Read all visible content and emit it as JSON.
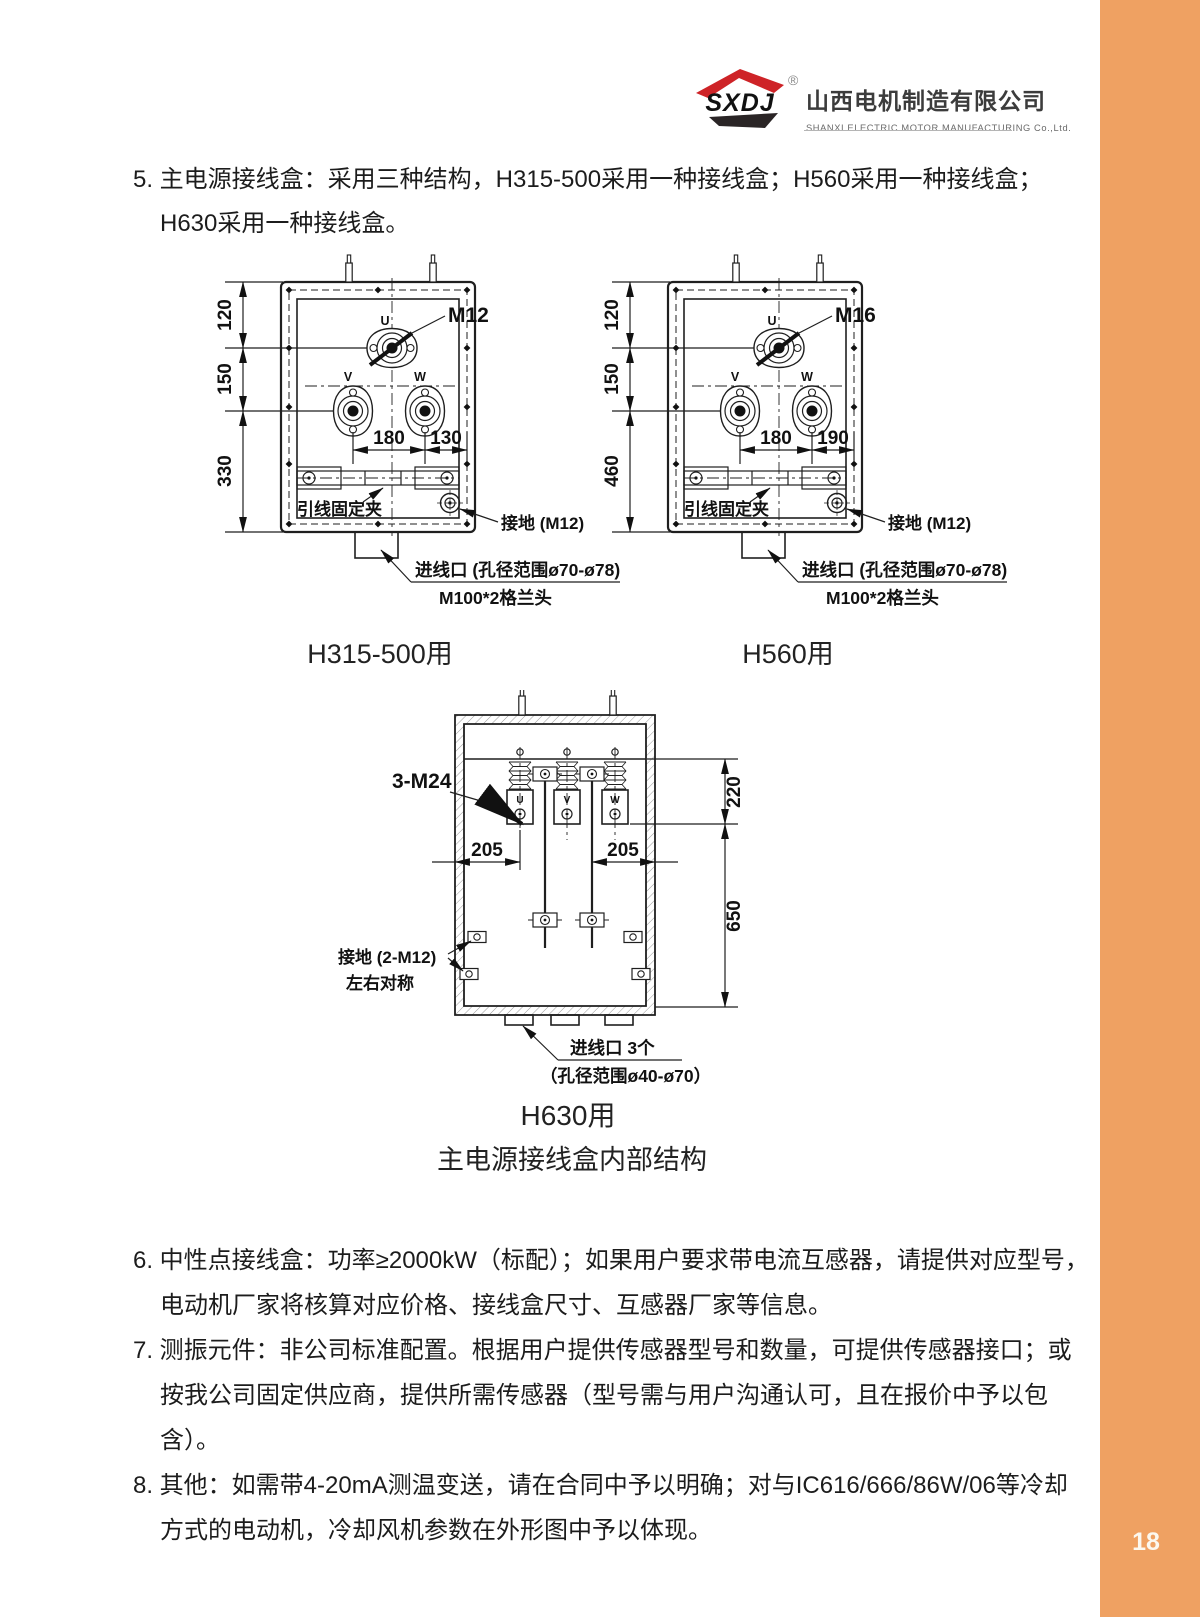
{
  "header": {
    "logo_abbr": "SXDJ",
    "registered_mark": "®",
    "company_name_cn": "山西电机制造有限公司",
    "company_name_en": "SHANXI ELECTRIC MOTOR MANUFACTURING Co.,Ltd."
  },
  "notes_top": {
    "n5_line1": "5. 主电源接线盒：采用三种结构，H315-500采用一种接线盒；H560采用一种接线盒；",
    "n5_line2": "H630采用一种接线盒。"
  },
  "notes_bottom": {
    "n6_line1": "6. 中性点接线盒：功率≥2000kW（标配）；如果用户要求带电流互感器，请提供对应型号，",
    "n6_line2": "电动机厂家将核算对应价格、接线盒尺寸、互感器厂家等信息。",
    "n7_line1": "7. 测振元件：非公司标准配置。根据用户提供传感器型号和数量，可提供传感器接口；或",
    "n7_line2": "按我公司固定供应商，提供所需传感器（型号需与用户沟通认可，且在报价中予以包含）。",
    "n8_line1": "8. 其他：如需带4-20mA测温变送，请在合同中予以明确；对与IC616/666/86W/06等冷却",
    "n8_line2": "方式的电动机，冷却风机参数在外形图中予以体现。"
  },
  "fig_h315": {
    "caption": "H315-500用",
    "bolt_spec": "M12",
    "dim_v1": "120",
    "dim_v2": "150",
    "dim_v3": "330",
    "dim_h1": "180",
    "dim_h2": "130",
    "term_u": "U",
    "term_v": "V",
    "term_w": "W",
    "clip_label": "引线固定夹",
    "ground_label": "接地 (M12)",
    "inlet_line1": "进线口 (孔径范围ø70-ø78)",
    "inlet_line2": "M100*2格兰头"
  },
  "fig_h560": {
    "caption": "H560用",
    "bolt_spec": "M16",
    "dim_v1": "120",
    "dim_v2": "150",
    "dim_v3": "460",
    "dim_h1": "180",
    "dim_h2": "190",
    "term_u": "U",
    "term_v": "V",
    "term_w": "W",
    "clip_label": "引线固定夹",
    "ground_label": "接地 (M12)",
    "inlet_line1": "进线口 (孔径范围ø70-ø78)",
    "inlet_line2": "M100*2格兰头"
  },
  "fig_h630": {
    "caption": "H630用",
    "bolt_spec": "3-M24",
    "dim_h1": "205",
    "dim_h2": "205",
    "dim_v1": "220",
    "dim_v2": "650",
    "term_u": "U",
    "term_v": "V",
    "term_w": "W",
    "ground_line1": "接地 (2-M12)",
    "ground_line2": "左右对称",
    "inlet_line1": "进线口 3个",
    "inlet_line2": "（孔径范围ø40-ø70）"
  },
  "figures_subtitle": "主电源接线盒内部结构",
  "page": {
    "number": "18"
  },
  "colors": {
    "accent_orange": "#EFA162",
    "logo_red": "#CE2327",
    "logo_black": "#2A2526",
    "ink": "#1C1C1C"
  }
}
